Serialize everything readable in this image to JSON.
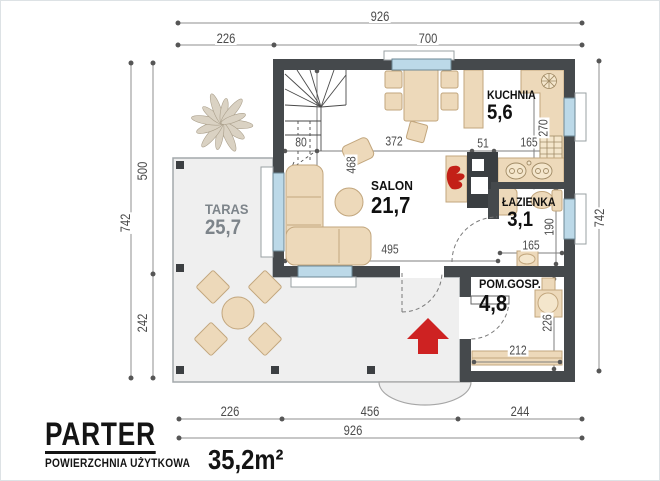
{
  "plan": {
    "title": "PARTER",
    "subtitle": "POWIERZCHNIA UŻYTKOWA",
    "total_area": "35,2m²",
    "rooms": {
      "kuchnia": {
        "name": "KUCHNIA",
        "area": "5,6"
      },
      "salon": {
        "name": "SALON",
        "area": "21,7"
      },
      "lazienka": {
        "name": "ŁAZIENKA",
        "area": "3,1"
      },
      "pomgosp": {
        "name": "POM.GOSP.",
        "area": "4,8"
      },
      "taras": {
        "name": "TARAS",
        "area": "25,7"
      }
    },
    "dims": {
      "top": {
        "total": "926",
        "seg1": "226",
        "seg2": "700"
      },
      "bottom": {
        "total": "926",
        "seg1": "226",
        "seg2": "456",
        "seg3": "244"
      },
      "left": {
        "total": "742",
        "seg1": "500",
        "seg2": "242"
      },
      "right": {
        "total": "742"
      },
      "inner": {
        "stairs": "80",
        "salon_top": "372",
        "pass": "51",
        "kitchen_w": "165",
        "kitchen_d": "270",
        "salon_d": "468",
        "salon_w": "495",
        "bath_w": "165",
        "bath_d": "190",
        "util_d": "226",
        "util_w": "212"
      }
    },
    "colors": {
      "wall": "#45494c",
      "furniture": "#edd9ba",
      "window": "#bcd9e8",
      "terrace": "#efefef",
      "accent_red": "#ce2222"
    }
  }
}
